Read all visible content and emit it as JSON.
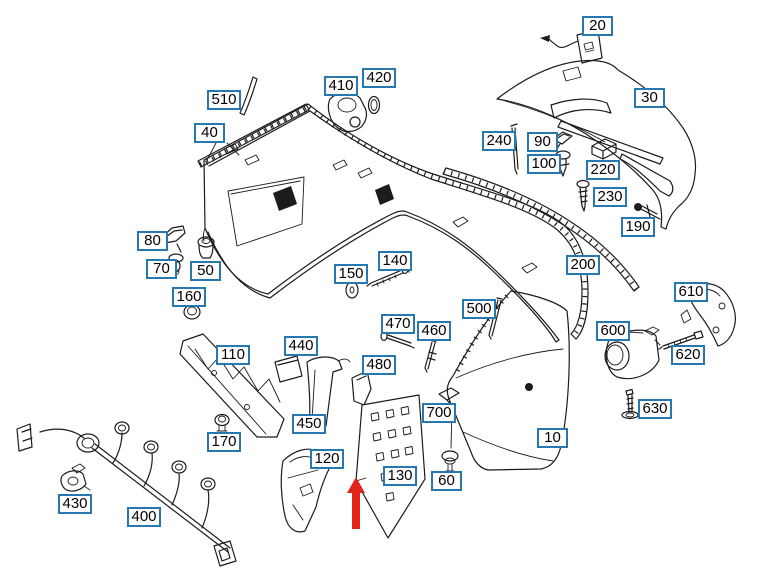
{
  "diagram": {
    "kind": "exploded-parts-diagram",
    "canvas": {
      "width": 767,
      "height": 578
    },
    "colors": {
      "background": "#ffffff",
      "line_art": "#1c1c1c",
      "callout_border": "#2878b0",
      "callout_fill": "#ffffff",
      "callout_text": "#000000",
      "arrow_red": "#e2231a"
    }
  },
  "arrow": {
    "tip_x": 356,
    "tip_y": 477,
    "tail_y": 529,
    "head_half_width": 9,
    "shaft_half_width": 4,
    "head_length": 16
  },
  "parts": [
    {
      "label": "20",
      "x": 582,
      "y": 16
    },
    {
      "label": "420",
      "x": 362,
      "y": 68
    },
    {
      "label": "410",
      "x": 324,
      "y": 76
    },
    {
      "label": "30",
      "x": 634,
      "y": 88
    },
    {
      "label": "510",
      "x": 207,
      "y": 90
    },
    {
      "label": "40",
      "x": 194,
      "y": 123
    },
    {
      "label": "240",
      "x": 482,
      "y": 131
    },
    {
      "label": "90",
      "x": 527,
      "y": 132
    },
    {
      "label": "100",
      "x": 527,
      "y": 154
    },
    {
      "label": "220",
      "x": 586,
      "y": 160
    },
    {
      "label": "230",
      "x": 593,
      "y": 187
    },
    {
      "label": "190",
      "x": 621,
      "y": 217
    },
    {
      "label": "80",
      "x": 137,
      "y": 231
    },
    {
      "label": "140",
      "x": 378,
      "y": 251
    },
    {
      "label": "200",
      "x": 566,
      "y": 255
    },
    {
      "label": "70",
      "x": 146,
      "y": 259
    },
    {
      "label": "50",
      "x": 190,
      "y": 261
    },
    {
      "label": "150",
      "x": 334,
      "y": 264
    },
    {
      "label": "610",
      "x": 674,
      "y": 282
    },
    {
      "label": "160",
      "x": 172,
      "y": 287
    },
    {
      "label": "500",
      "x": 462,
      "y": 299
    },
    {
      "label": "470",
      "x": 381,
      "y": 314
    },
    {
      "label": "460",
      "x": 417,
      "y": 321
    },
    {
      "label": "600",
      "x": 596,
      "y": 321
    },
    {
      "label": "440",
      "x": 284,
      "y": 336
    },
    {
      "label": "110",
      "x": 216,
      "y": 345
    },
    {
      "label": "620",
      "x": 671,
      "y": 345
    },
    {
      "label": "480",
      "x": 362,
      "y": 355
    },
    {
      "label": "630",
      "x": 638,
      "y": 399
    },
    {
      "label": "700",
      "x": 422,
      "y": 403
    },
    {
      "label": "450",
      "x": 292,
      "y": 414
    },
    {
      "label": "10",
      "x": 537,
      "y": 428
    },
    {
      "label": "170",
      "x": 207,
      "y": 432
    },
    {
      "label": "120",
      "x": 310,
      "y": 449
    },
    {
      "label": "130",
      "x": 383,
      "y": 466
    },
    {
      "label": "60",
      "x": 431,
      "y": 471
    },
    {
      "label": "430",
      "x": 58,
      "y": 494
    },
    {
      "label": "400",
      "x": 127,
      "y": 507
    }
  ]
}
